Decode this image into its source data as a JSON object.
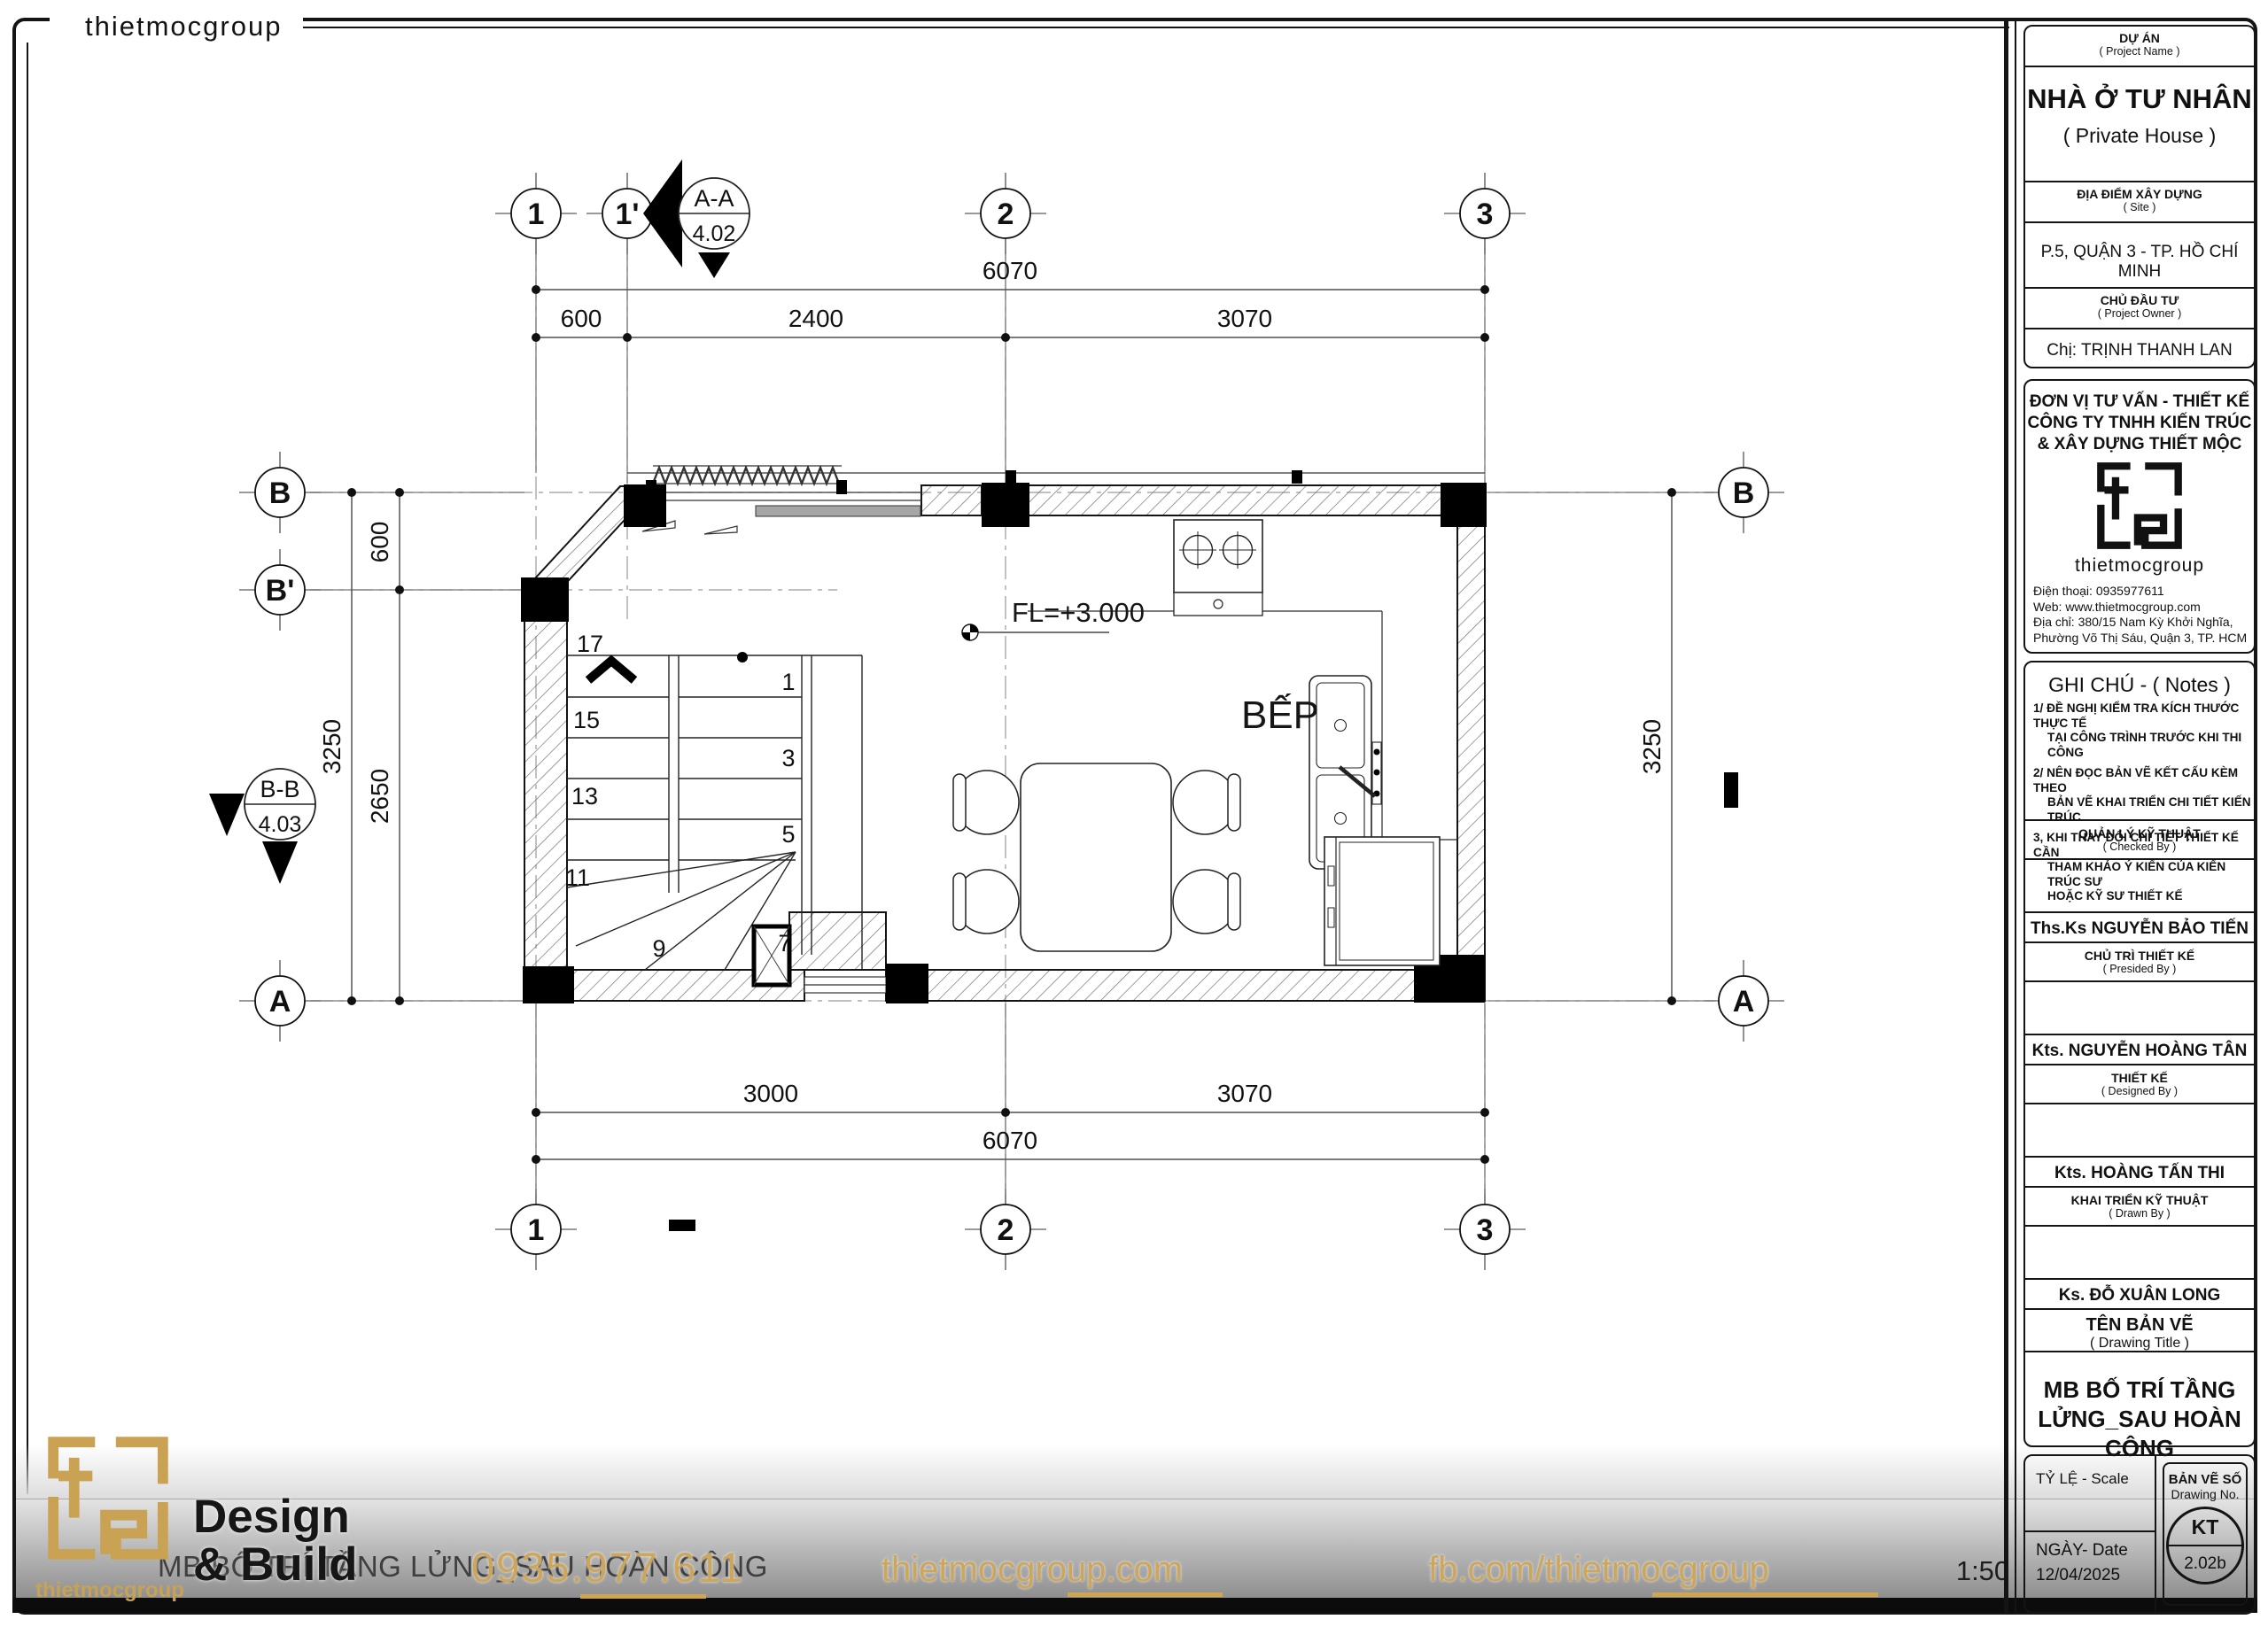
{
  "page": {
    "brand": "thietmocgroup"
  },
  "plan": {
    "room_label": "BẾP",
    "level_label": "FL=+3.000",
    "grids": {
      "g1": "1",
      "g1p": "1'",
      "g2": "2",
      "g3": "3",
      "gB": "B",
      "gBp": "B'",
      "gA": "A"
    },
    "sections": {
      "aa": "A-A",
      "aa_ref": "4.02",
      "bb": "B-B",
      "bb_ref": "4.03"
    },
    "dims": {
      "total": "6070",
      "d600": "600",
      "d2400": "2400",
      "d3070": "3070",
      "d3000": "3000",
      "v600": "600",
      "v2650": "2650",
      "v3250": "3250"
    },
    "stairs": {
      "s1": "1",
      "s3": "3",
      "s5": "5",
      "s7": "7",
      "s9": "9",
      "s11": "11",
      "s13": "13",
      "s15": "15",
      "s17": "17"
    }
  },
  "titleblock": {
    "project_label": "DỰ ÁN",
    "project_label_en": "( Project Name )",
    "project_name": "NHÀ Ở TƯ NHÂN",
    "project_name_en": "( Private House )",
    "site_label": "ĐỊA ĐIỂM XÂY DỰNG",
    "site_label_en": "( Site )",
    "site": "P.5, QUẬN 3 - TP. HỒ CHÍ MINH",
    "owner_label": "CHỦ ĐẦU TƯ",
    "owner_label_en": "( Project Owner )",
    "owner": "Chị: TRỊNH THANH LAN",
    "consultant_line1": "ĐƠN VỊ TƯ VẤN - THIẾT KẾ",
    "consultant_line2": "CÔNG TY TNHH KIẾN TRÚC",
    "consultant_line3": "& XÂY DỰNG THIẾT MỘC",
    "brand": "thietmocgroup",
    "contact_phone": "Điện thoại: 0935977611",
    "contact_web": "Web: www.thietmocgroup.com",
    "contact_addr1": "Địa chỉ: 380/15 Nam Kỳ Khởi Nghĩa,",
    "contact_addr2": "Phường Võ Thị Sáu, Quận 3, TP. HCM",
    "notes_title": "GHI CHÚ - ( Notes )",
    "notes_lines": [
      "1/ ĐỀ NGHỊ KIỂM TRA KÍCH THƯỚC THỰC TẾ",
      "   TẠI CÔNG TRÌNH TRƯỚC KHI THI CÔNG",
      "2/ NÊN ĐỌC BẢN VẼ KẾT CẤU KÈM THEO",
      "   BẢN VẼ KHAI TRIỂN CHI TIẾT KIẾN TRÚC",
      "3, KHI THAY ĐỔI CHI TIẾT THIẾT KẾ CẦN",
      "   THAM KHẢO Ý KIẾN CỦA KIẾN TRÚC SƯ",
      "   HOẶC KỸ SƯ THIẾT KẾ"
    ],
    "signatures": [
      {
        "role": "QUẢN LÝ KỸ THUẬT",
        "role_en": "( Checked By )",
        "name": "Ths.Ks NGUYỄN BẢO TIẾN"
      },
      {
        "role": "CHỦ TRÌ THIẾT KẾ",
        "role_en": "( Presided By )",
        "name": "Kts. NGUYỄN HOÀNG TÂN"
      },
      {
        "role": "THIẾT KẾ",
        "role_en": "( Designed By )",
        "name": "Kts. HOÀNG TẤN THI"
      },
      {
        "role": "KHAI TRIỂN KỸ THUẬT",
        "role_en": "( Drawn By )",
        "name": "Ks. ĐỖ XUÂN LONG"
      }
    ],
    "drawing_title_label": "TÊN BẢN VẼ",
    "drawing_title_label_en": "( Drawing Title )",
    "drawing_title_l1": "MB BỐ TRÍ TẦNG",
    "drawing_title_l2": "LỬNG_SAU HOÀN CÔNG",
    "scale_label": "TỶ LỆ - Scale",
    "date_label": "NGÀY- Date",
    "date": "12/04/2025",
    "sheet_label": "BẢN VẼ SỐ",
    "sheet_label_en": "Drawing No.",
    "sheet_code": "KT",
    "sheet_no": "2.02b"
  },
  "footer": {
    "brand": "thietmocgroup",
    "design_l1": "Design",
    "design_l2": "& Build",
    "ghost_title": "MB BỐ TRÍ TẦNG LỬNG_SAU HOÀN CÔNG",
    "phone": "0935.977.611",
    "website": "thietmocgroup.com",
    "facebook": "fb.com/thietmocgroup",
    "scale": "1:50",
    "accent_gold": "#c8a254"
  }
}
